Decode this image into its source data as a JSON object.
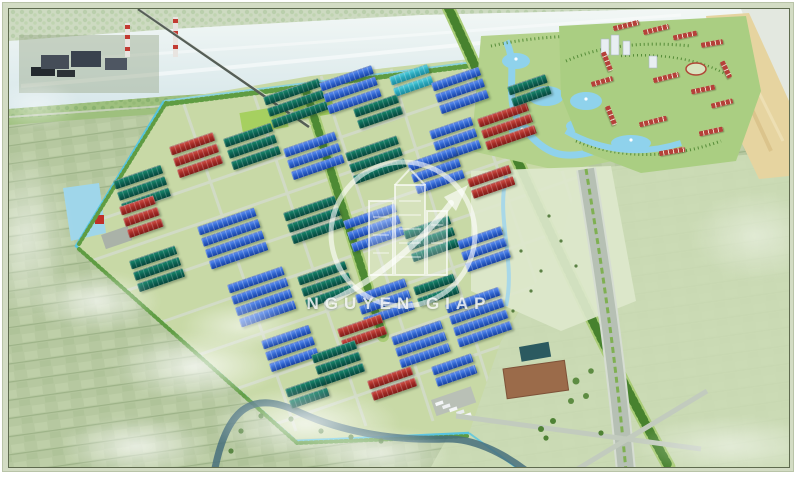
{
  "watermark": {
    "text": "NGUYEN GIAP"
  },
  "palette": {
    "roof_blue": "#2d62cc",
    "roof_teal": "#0c6252",
    "roof_red": "#a32b26",
    "roof_cyan": "#2aa8bc",
    "residential_roof": "#b5413a",
    "park_lawn": "#c8d9a6",
    "farmland": "#b7c8a2",
    "river": "#e6f0f0",
    "sand": "#e6d4a0",
    "canal": "#52c4e4",
    "highway": "#b6c0b4",
    "tree_green": "#4d8a34",
    "watermark_white": "rgba(255,255,255,0.7)"
  },
  "scene": {
    "regions": [
      "river",
      "far-bank-village",
      "power-plant",
      "bridge",
      "industrial-park",
      "residential-town",
      "lake-park",
      "sand-bank",
      "farmland-southwest",
      "farmland-east",
      "highway",
      "stream"
    ],
    "building_clusters": [
      {
        "x": 262,
        "y": 96,
        "rows": 3,
        "len": 58,
        "color": "teal"
      },
      {
        "x": 318,
        "y": 82,
        "rows": 3,
        "len": 55,
        "color": "blue"
      },
      {
        "x": 388,
        "y": 76,
        "rows": 2,
        "len": 40,
        "color": "cyan"
      },
      {
        "x": 430,
        "y": 82,
        "rows": 3,
        "len": 50,
        "color": "blue"
      },
      {
        "x": 352,
        "y": 108,
        "rows": 2,
        "len": 46,
        "color": "teal"
      },
      {
        "x": 476,
        "y": 118,
        "rows": 3,
        "len": 52,
        "color": "red"
      },
      {
        "x": 428,
        "y": 130,
        "rows": 3,
        "len": 44,
        "color": "blue"
      },
      {
        "x": 506,
        "y": 86,
        "rows": 2,
        "len": 40,
        "color": "teal"
      },
      {
        "x": 168,
        "y": 146,
        "rows": 3,
        "len": 46,
        "color": "red"
      },
      {
        "x": 222,
        "y": 138,
        "rows": 3,
        "len": 50,
        "color": "teal"
      },
      {
        "x": 282,
        "y": 148,
        "rows": 3,
        "len": 54,
        "color": "blue"
      },
      {
        "x": 344,
        "y": 152,
        "rows": 3,
        "len": 54,
        "color": "teal"
      },
      {
        "x": 406,
        "y": 162,
        "rows": 3,
        "len": 50,
        "color": "blue"
      },
      {
        "x": 466,
        "y": 178,
        "rows": 2,
        "len": 44,
        "color": "red"
      },
      {
        "x": 112,
        "y": 180,
        "rows": 3,
        "len": 50,
        "color": "teal"
      },
      {
        "x": 118,
        "y": 206,
        "rows": 3,
        "len": 36,
        "color": "red"
      },
      {
        "x": 196,
        "y": 226,
        "rows": 4,
        "len": 60,
        "color": "blue"
      },
      {
        "x": 282,
        "y": 212,
        "rows": 3,
        "len": 54,
        "color": "teal"
      },
      {
        "x": 342,
        "y": 220,
        "rows": 3,
        "len": 54,
        "color": "blue"
      },
      {
        "x": 402,
        "y": 230,
        "rows": 3,
        "len": 48,
        "color": "teal"
      },
      {
        "x": 456,
        "y": 240,
        "rows": 3,
        "len": 46,
        "color": "blue"
      },
      {
        "x": 128,
        "y": 260,
        "rows": 3,
        "len": 48,
        "color": "teal"
      },
      {
        "x": 226,
        "y": 284,
        "rows": 4,
        "len": 58,
        "color": "blue"
      },
      {
        "x": 296,
        "y": 276,
        "rows": 3,
        "len": 50,
        "color": "teal"
      },
      {
        "x": 354,
        "y": 294,
        "rows": 3,
        "len": 52,
        "color": "blue"
      },
      {
        "x": 412,
        "y": 286,
        "rows": 2,
        "len": 42,
        "color": "teal"
      },
      {
        "x": 444,
        "y": 304,
        "rows": 4,
        "len": 56,
        "color": "blue"
      },
      {
        "x": 336,
        "y": 328,
        "rows": 2,
        "len": 46,
        "color": "red"
      },
      {
        "x": 260,
        "y": 340,
        "rows": 3,
        "len": 50,
        "color": "blue"
      },
      {
        "x": 310,
        "y": 354,
        "rows": 3,
        "len": 46,
        "color": "teal"
      },
      {
        "x": 390,
        "y": 336,
        "rows": 3,
        "len": 52,
        "color": "blue"
      },
      {
        "x": 366,
        "y": 380,
        "rows": 2,
        "len": 46,
        "color": "red"
      },
      {
        "x": 430,
        "y": 366,
        "rows": 2,
        "len": 42,
        "color": "blue"
      },
      {
        "x": 284,
        "y": 388,
        "rows": 2,
        "len": 40,
        "color": "teal"
      }
    ],
    "residential_strips": [
      {
        "x": 612,
        "y": 22,
        "rot": -14,
        "len": 26
      },
      {
        "x": 642,
        "y": 26,
        "rot": -14,
        "len": 26
      },
      {
        "x": 672,
        "y": 32,
        "rot": -12,
        "len": 24
      },
      {
        "x": 700,
        "y": 40,
        "rot": -10,
        "len": 22
      },
      {
        "x": 596,
        "y": 58,
        "rot": 68,
        "len": 20
      },
      {
        "x": 652,
        "y": 74,
        "rot": -14,
        "len": 26
      },
      {
        "x": 690,
        "y": 86,
        "rot": -12,
        "len": 24
      },
      {
        "x": 710,
        "y": 100,
        "rot": -14,
        "len": 22
      },
      {
        "x": 600,
        "y": 112,
        "rot": 68,
        "len": 20
      },
      {
        "x": 638,
        "y": 118,
        "rot": -14,
        "len": 28
      },
      {
        "x": 698,
        "y": 128,
        "rot": -12,
        "len": 24
      },
      {
        "x": 658,
        "y": 148,
        "rot": -10,
        "len": 26
      },
      {
        "x": 590,
        "y": 78,
        "rot": -16,
        "len": 22
      },
      {
        "x": 716,
        "y": 66,
        "rot": 64,
        "len": 18
      }
    ],
    "clouds": [
      {
        "x": 30,
        "y": 270,
        "w": 130,
        "h": 60,
        "o": 0.75
      },
      {
        "x": 110,
        "y": 330,
        "w": 170,
        "h": 70,
        "o": 0.8
      },
      {
        "x": 210,
        "y": 385,
        "w": 190,
        "h": 75,
        "o": 0.8
      },
      {
        "x": 60,
        "y": 415,
        "w": 150,
        "h": 60,
        "o": 0.75
      },
      {
        "x": 300,
        "y": 425,
        "w": 150,
        "h": 55,
        "o": 0.7
      },
      {
        "x": -20,
        "y": 150,
        "w": 90,
        "h": 170,
        "o": 0.6
      },
      {
        "x": -10,
        "y": 80,
        "w": 90,
        "h": 50,
        "o": 0.5
      },
      {
        "x": 630,
        "y": 415,
        "w": 200,
        "h": 60,
        "o": 0.5
      },
      {
        "x": 690,
        "y": 190,
        "w": 130,
        "h": 90,
        "o": 0.45
      },
      {
        "x": 180,
        "y": 300,
        "w": 120,
        "h": 50,
        "o": 0.6
      }
    ]
  }
}
